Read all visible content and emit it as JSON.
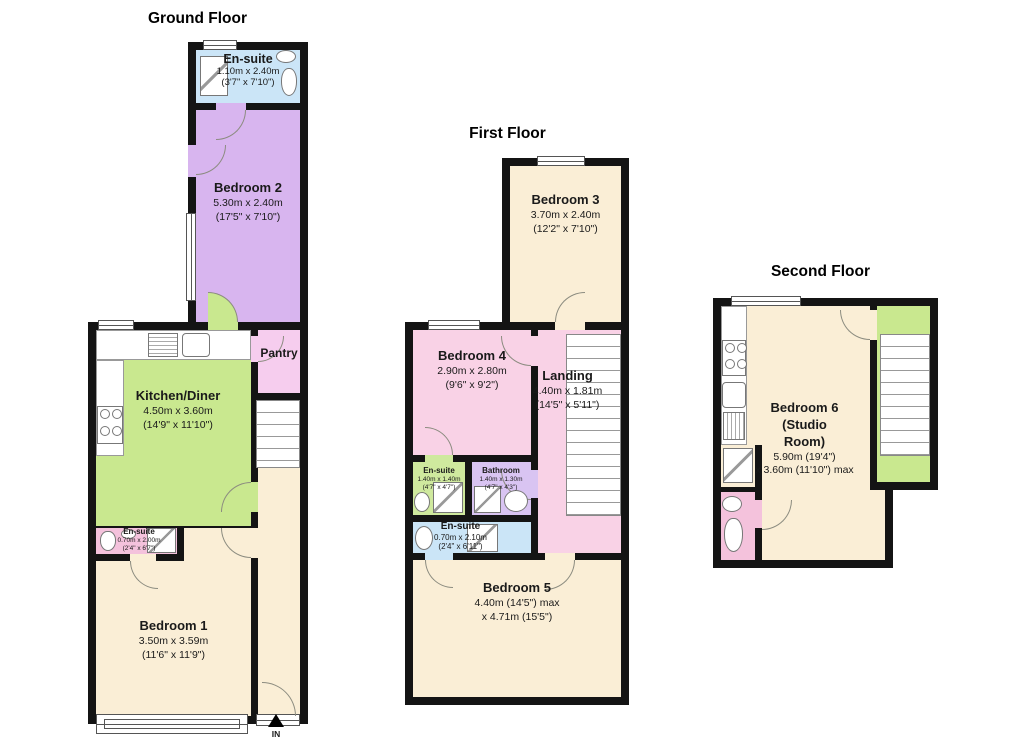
{
  "colors": {
    "wall": "#141414",
    "cream": "#faeed6",
    "purple": "#d8b5ef",
    "blue": "#cbe5f7",
    "green": "#c9e88f",
    "ensuite_green": "#cfe99e",
    "pink_light": "#f6cdee",
    "pink": "#f9d2e6",
    "pink_deep": "#f4c2dc",
    "lavender": "#d9c4f2",
    "stair_green": "#c9e88f"
  },
  "floors": {
    "ground": {
      "title": "Ground Floor",
      "entrance": "IN",
      "rooms": {
        "ensuite_top": {
          "name": "En-suite",
          "dim1": "1.10m x 2.40m",
          "dim2": "(3'7\" x 7'10\")"
        },
        "bedroom2": {
          "name": "Bedroom 2",
          "dim1": "5.30m x 2.40m",
          "dim2": "(17'5\" x 7'10\")"
        },
        "kitchen": {
          "name": "Kitchen/Diner",
          "dim1": "4.50m x 3.60m",
          "dim2": "(14'9\" x 11'10\")"
        },
        "pantry": {
          "name": "Pantry"
        },
        "ensuite_mid": {
          "name": "En-suite",
          "dim1": "0.70m x 2.00m",
          "dim2": "(2'4\" x 6'7\")"
        },
        "bedroom1": {
          "name": "Bedroom 1",
          "dim1": "3.50m x 3.59m",
          "dim2": "(11'6\" x 11'9\")"
        }
      }
    },
    "first": {
      "title": "First Floor",
      "rooms": {
        "bedroom3": {
          "name": "Bedroom 3",
          "dim1": "3.70m x 2.40m",
          "dim2": "(12'2\" x 7'10\")"
        },
        "bedroom4": {
          "name": "Bedroom 4",
          "dim1": "2.90m x 2.80m",
          "dim2": "(9'6\" x 9'2\")"
        },
        "landing": {
          "name": "Landing",
          "dim1": "4.40m x 1.81m",
          "dim2": "(14'5\" x 5'11\")"
        },
        "ensuite_a": {
          "name": "En-suite",
          "dim1": "1.40m x 1.40m",
          "dim2": "(4'7\" x 4'7\")"
        },
        "bathroom": {
          "name": "Bathroom",
          "dim1": "1.40m x 1.30m",
          "dim2": "(4'7\" x 4'3\")"
        },
        "ensuite_b": {
          "name": "En-suite",
          "dim1": "0.70m x 2.10m",
          "dim2": "(2'4\" x 6'11\")"
        },
        "bedroom5": {
          "name": "Bedroom 5",
          "dim1": "4.40m (14'5\") max",
          "dim2": "x 4.71m (15'5\")"
        }
      }
    },
    "second": {
      "title": "Second Floor",
      "rooms": {
        "bedroom6": {
          "name": "Bedroom 6",
          "name2": "(Studio",
          "name3": "Room)",
          "dim1": "5.90m (19'4\")",
          "dim2": "x 3.60m (11'10\") max"
        }
      }
    }
  }
}
